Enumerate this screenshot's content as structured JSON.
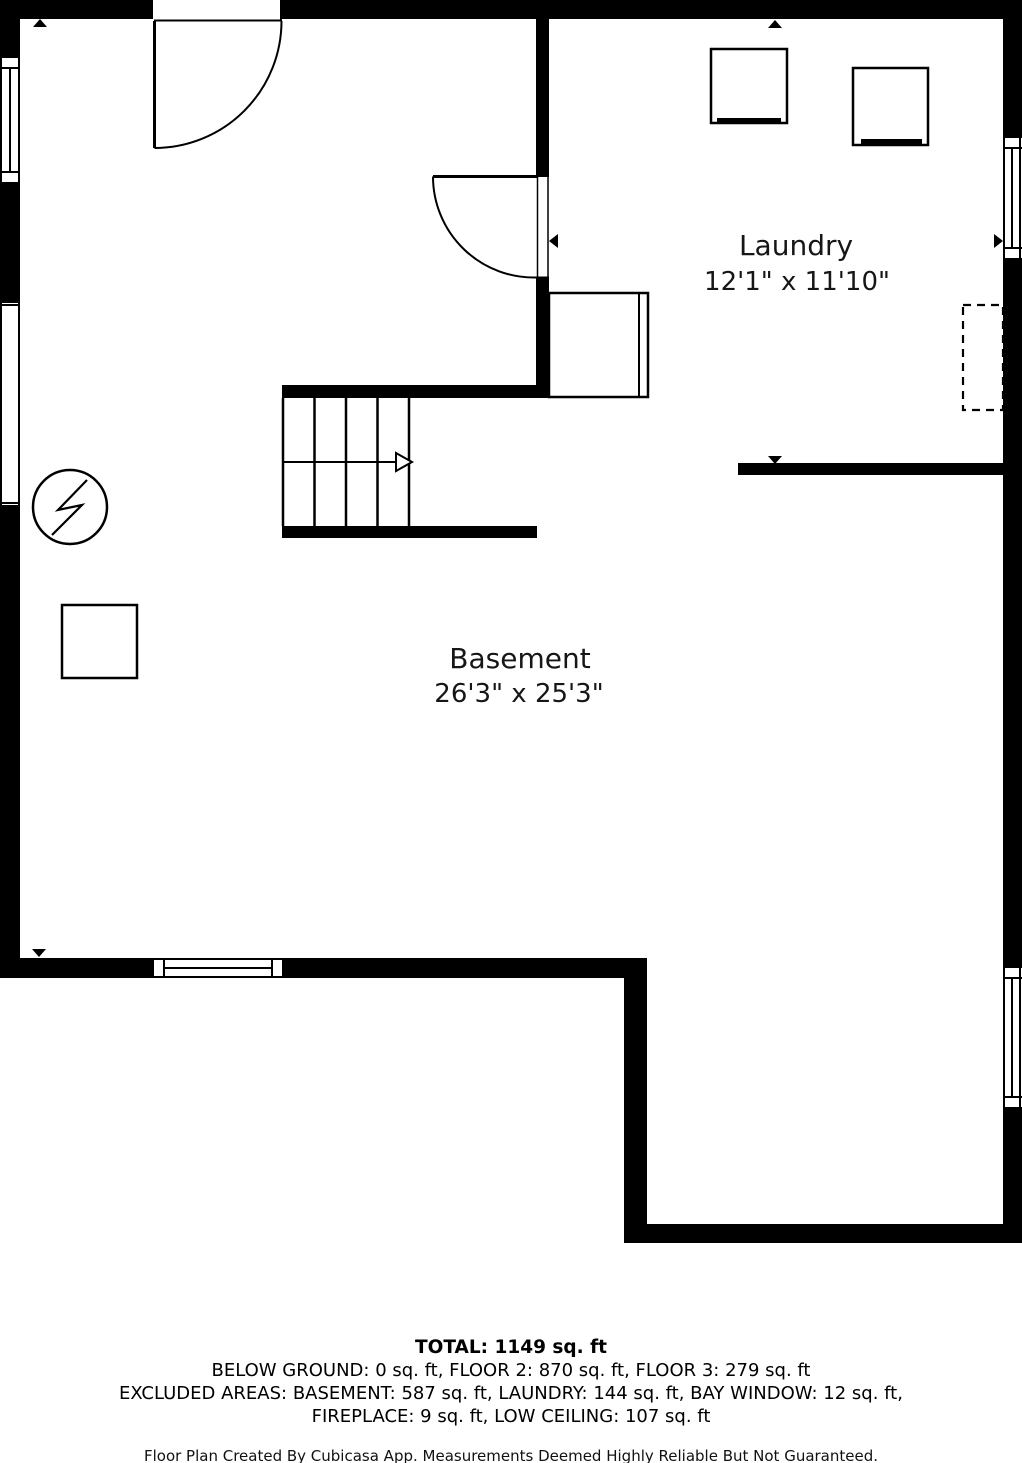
{
  "rooms": [
    {
      "name": "Laundry",
      "dimensions": "12'1\" x 11'10\""
    },
    {
      "name": "Basement",
      "dimensions": "26'3\" x 25'3\""
    }
  ],
  "summary": {
    "total": "TOTAL: 1149 sq. ft",
    "floors": "BELOW GROUND: 0 sq. ft, FLOOR 2: 870 sq. ft, FLOOR 3: 279 sq. ft",
    "excluded1": "EXCLUDED AREAS: BASEMENT: 587 sq. ft, LAUNDRY: 144 sq. ft, BAY WINDOW: 12 sq. ft,",
    "excluded2": "FIREPLACE: 9 sq. ft, LOW CEILING: 107 sq. ft"
  },
  "footer": "Floor Plan Created By Cubicasa App. Measurements Deemed Highly Reliable But Not Guaranteed.",
  "colors": {
    "wall": "#000000",
    "background": "#ffffff"
  }
}
